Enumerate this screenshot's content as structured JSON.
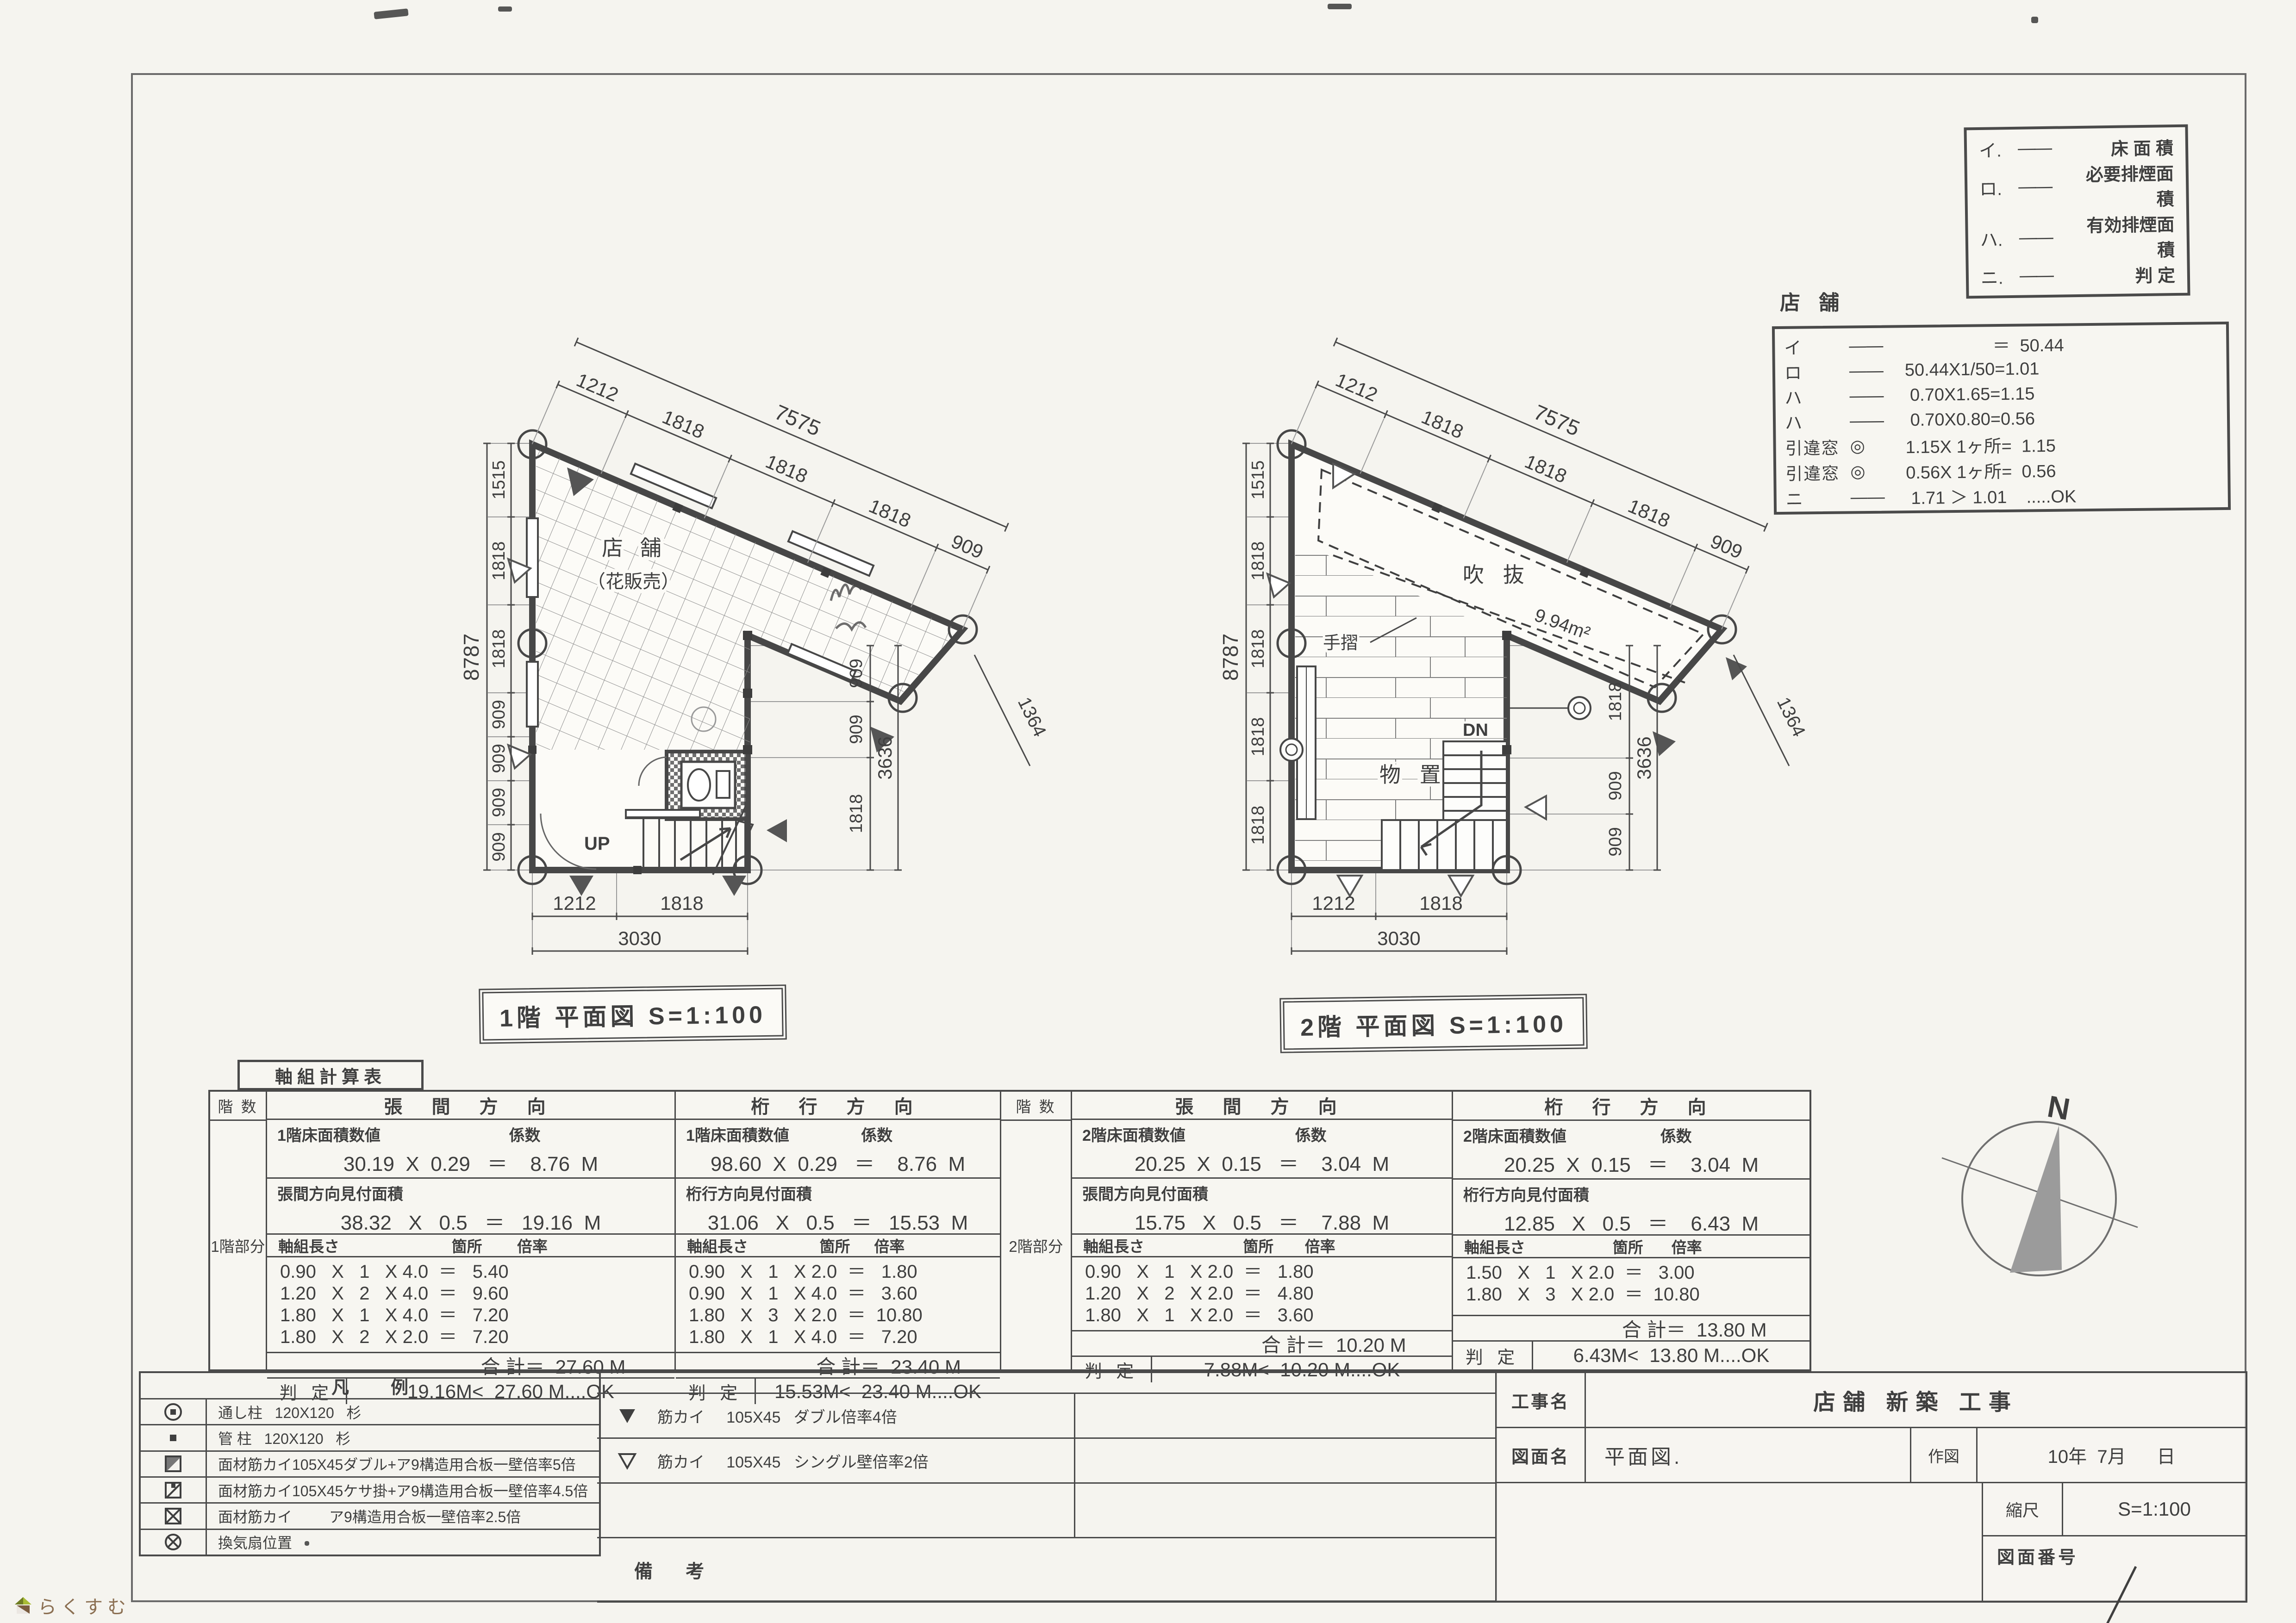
{
  "legend_box": {
    "dash": "――",
    "rows": [
      {
        "key": "イ.",
        "label": "床 面 積"
      },
      {
        "key": "ロ.",
        "label": "必要排煙面積"
      },
      {
        "key": "ハ.",
        "label": "有効排煙面積"
      },
      {
        "key": "ニ.",
        "label": "判   定"
      }
    ]
  },
  "smoke_calc": {
    "title": "店 舗",
    "rows": [
      {
        "key": "イ",
        "mark": "――",
        "expr": "                  ＝  50.44"
      },
      {
        "key": "ロ",
        "mark": "――",
        "expr": "50.44X1/50=1.01"
      },
      {
        "key": "ハ",
        "mark": "――",
        "expr": " 0.70X1.65=1.15"
      },
      {
        "key": "ハ",
        "mark": "――",
        "expr": " 0.70X0.80=0.56"
      },
      {
        "key": "引違窓",
        "mark": "◎",
        "expr": "1.15X 1ヶ所=  1.15"
      },
      {
        "key": "引違窓",
        "mark": "◎",
        "expr": "0.56X 1ヶ所=  0.56"
      },
      {
        "key": "ニ",
        "mark": "――",
        "expr": " 1.71 ＞ 1.01    .....OK"
      }
    ]
  },
  "floor1": {
    "title": "1階  平面図  S=1:100",
    "labels": {
      "room": "店 舗",
      "room2": "（花販売）",
      "up": "UP"
    },
    "dims": {
      "top_total": "7575",
      "top": [
        "1212",
        "1818",
        "1818",
        "1818",
        "909"
      ],
      "left_total": "8787",
      "left": [
        "1515",
        "1818",
        "1818",
        "909",
        "909",
        "909",
        "909"
      ],
      "right_total": "3636",
      "right": [
        "909",
        "909",
        "1818"
      ],
      "bottom_total": "3030",
      "bottom": [
        "1212",
        "1818"
      ],
      "diag": "1364"
    }
  },
  "floor2": {
    "title": "2階  平面図  S=1:100",
    "labels": {
      "void": "吹 抜",
      "void_area": "9.94m²",
      "handrail": "手摺",
      "storage": "物 置",
      "dn": "DN"
    },
    "dims": {
      "top_total": "7575",
      "top": [
        "1212",
        "1818",
        "1818",
        "1818",
        "909"
      ],
      "left_total": "8787",
      "left": [
        "1515",
        "1818",
        "1818",
        "1818",
        "1818"
      ],
      "right_total": "3636",
      "right": [
        "1818",
        "909",
        "909"
      ],
      "bottom_total": "3030",
      "bottom": [
        "1212",
        "1818"
      ],
      "diag": "1364"
    }
  },
  "wall_table": {
    "title": "軸組計算表",
    "floor_header": "階 数",
    "floor1_label": "1階部分",
    "floor2_label": "2階部分",
    "groups": [
      {
        "dir": "張 間 方 向",
        "area_label": "1階床面積数値",
        "coef_label": "係数",
        "area_expr": "30.19  X  0.29   ＝    8.76  M",
        "facade_label": "張間方向見付面積",
        "facade_expr": "38.32   X   0.5   ＝   19.16  M",
        "col1": "軸組長さ",
        "col2": "箇所",
        "col3": "倍率",
        "rows": [
          "0.90   X   1   X 4.0  ＝   5.40",
          "1.20   X   2   X 4.0  ＝   9.60",
          "1.80   X   1   X 4.0  ＝   7.20",
          "1.80   X   2   X 2.0  ＝   7.20"
        ],
        "total": "合 計＝  27.60 M",
        "judge_label": "判 定",
        "judge": "19.16M<  27.60 M....OK"
      },
      {
        "dir": "桁 行 方 向",
        "area_label": "1階床面積数値",
        "coef_label": "係数",
        "area_expr": "98.60  X  0.29   ＝    8.76  M",
        "facade_label": "桁行方向見付面積",
        "facade_expr": "31.06   X   0.5   ＝   15.53  M",
        "col1": "軸組長さ",
        "col2": "箇所",
        "col3": "倍率",
        "rows": [
          "0.90   X   1   X 2.0  ＝   1.80",
          "0.90   X   1   X 4.0  ＝   3.60",
          "1.80   X   3   X 2.0  ＝  10.80",
          "1.80   X   1   X 4.0  ＝   7.20"
        ],
        "total": "合 計＝  23.40 M",
        "judge_label": "判 定",
        "judge": "15.53M<  23.40 M....OK"
      },
      {
        "dir": "張 間 方 向",
        "area_label": "2階床面積数値",
        "coef_label": "係数",
        "area_expr": "20.25  X  0.15   ＝    3.04  M",
        "facade_label": "張間方向見付面積",
        "facade_expr": "15.75   X   0.5   ＝    7.88  M",
        "col1": "軸組長さ",
        "col2": "箇所",
        "col3": "倍率",
        "rows": [
          "0.90   X   1   X 2.0  ＝   1.80",
          "1.20   X   2   X 2.0  ＝   4.80",
          "1.80   X   1   X 2.0  ＝   3.60"
        ],
        "total": "合 計＝  10.20 M",
        "judge_label": "判 定",
        "judge": "7.88M<  10.20 M....OK"
      },
      {
        "dir": "桁 行 方 向",
        "area_label": "2階床面積数値",
        "coef_label": "係数",
        "area_expr": "20.25  X  0.15   ＝    3.04  M",
        "facade_label": "桁行方向見付面積",
        "facade_expr": "12.85   X   0.5   ＝    6.43  M",
        "col1": "軸組長さ",
        "col2": "箇所",
        "col3": "倍率",
        "rows": [
          "1.50   X   1   X 2.0  ＝   3.00",
          "1.80   X   3   X 2.0  ＝  10.80"
        ],
        "total": "合 計＝  13.80 M",
        "judge_label": "判 定",
        "judge": "6.43M<  13.80 M....OK"
      }
    ]
  },
  "legend_table": {
    "title": "凡例",
    "rows": [
      {
        "symbol": "through-post-icon",
        "desc": "通し柱   120X120   杉"
      },
      {
        "symbol": "standard-post-icon",
        "desc": "管 柱   120X120   杉"
      },
      {
        "symbol": "panel-brace-double-icon",
        "desc": "面材筋カイ105X45ダブル+ア9構造用合板一壁倍率5倍"
      },
      {
        "symbol": "panel-brace-kesa-icon",
        "desc": "面材筋カイ105X45ケサ掛+ア9構造用合板一壁倍率4.5倍"
      },
      {
        "symbol": "panel-brace-single-icon",
        "desc": "面材筋カイ         ア9構造用合板一壁倍率2.5倍"
      },
      {
        "symbol": "vent-fan-icon",
        "desc": "換気扇位置"
      }
    ]
  },
  "brace_table": {
    "rows": [
      {
        "symbol": "filled-triangle-icon",
        "desc": "筋カイ     105X45   ダブル倍率4倍"
      },
      {
        "symbol": "hollow-triangle-icon",
        "desc": "筋カイ     105X45   シングル壁倍率2倍"
      }
    ],
    "remarks_label": "備 考"
  },
  "title_block": {
    "project_label": "工事名",
    "project": "店舗  新築  工事",
    "drawing_label": "図面名",
    "drawing": "平面図.",
    "drawn_label": "作図",
    "drawn_date": "10年  7月      日",
    "scale_label": "縮尺",
    "scale": "S=1:100",
    "number_label": "図面番号"
  },
  "compass": {
    "north": "N"
  },
  "watermark": {
    "text": "らくすむ"
  }
}
